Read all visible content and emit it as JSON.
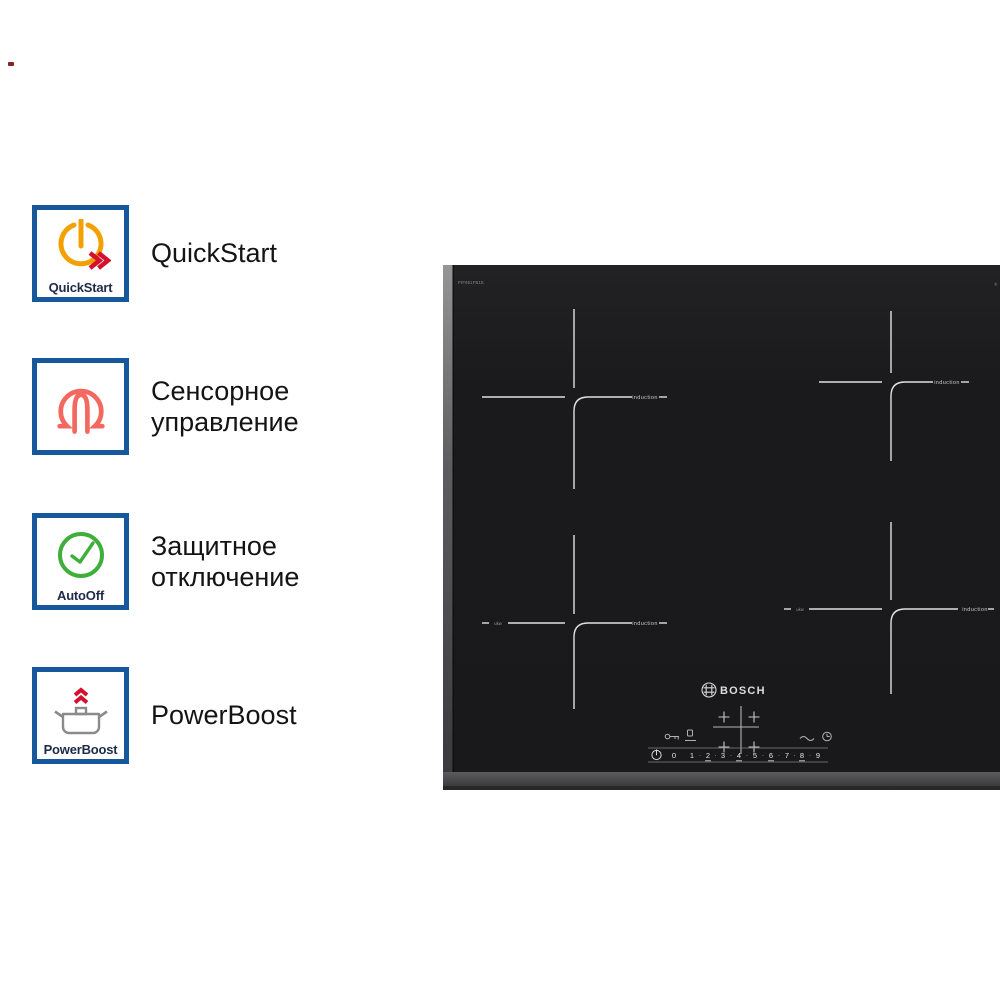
{
  "page": {
    "background": "#ffffff",
    "artifact_dot_color": "#8b2222"
  },
  "features": {
    "box_border_color": "#17579b",
    "caption_color": "#1e2b48",
    "label_color": "#141414",
    "icon_colors": {
      "orange": "#f2a100",
      "red": "#d5122d",
      "coral": "#f4695f",
      "green": "#3fae3a",
      "gray": "#8b8b8b"
    },
    "items": [
      {
        "icon": "quickstart-power-icon",
        "caption": "QuickStart",
        "label": "QuickStart"
      },
      {
        "icon": "touch-control-fingertip-icon",
        "caption": "",
        "label": "Сенсорное управление"
      },
      {
        "icon": "auto-off-clock-icon",
        "caption": "AutoOff",
        "label": "Защитное отключение"
      },
      {
        "icon": "powerboost-pot-icon",
        "caption": "PowerBoost",
        "label": "PowerBoost"
      }
    ]
  },
  "cooktop": {
    "glass_color": "#1a1a1c",
    "brand": "BOSCH",
    "model_text": "PIF651FB1E",
    "corner_mark": "*",
    "zones": [
      {
        "name": "top-left",
        "label": "induction"
      },
      {
        "name": "top-right",
        "label": "induction"
      },
      {
        "name": "bottom-left",
        "label": "induction",
        "side_label": "ukw"
      },
      {
        "name": "bottom-right",
        "label": "induction",
        "side_label": "ukw"
      }
    ],
    "controls": {
      "icon_names": [
        "child-lock-key-icon",
        "pause-icon",
        "boost-wave-icon",
        "timer-clock-icon",
        "power-icon"
      ],
      "slider": {
        "numbers": [
          "0",
          "1",
          "2",
          "3",
          "4",
          "5",
          "6",
          "7",
          "8",
          "9"
        ],
        "separator": "·"
      }
    }
  }
}
